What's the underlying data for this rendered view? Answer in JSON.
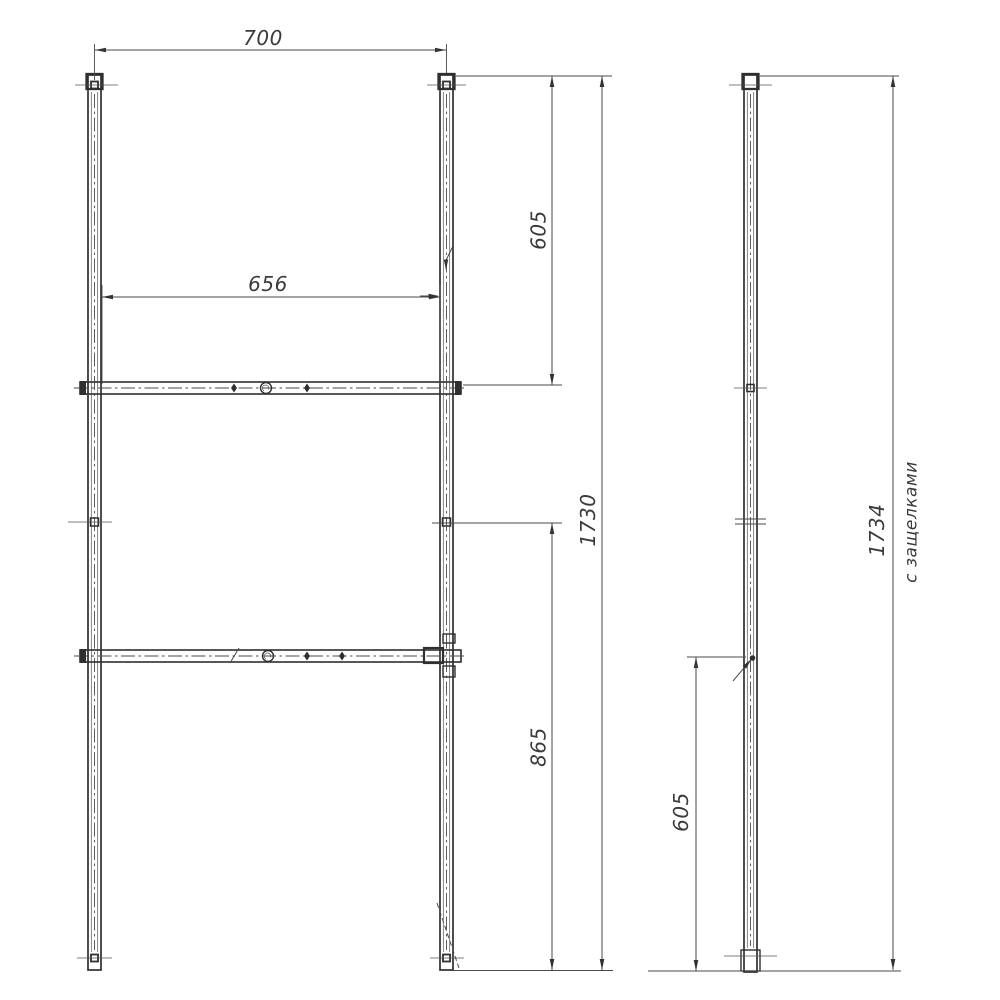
{
  "drawing": {
    "background": "#ffffff",
    "line_color": "#2f2f2f",
    "dim_color": "#4a4a4a",
    "front": {
      "width_top": "700",
      "rail_span": "656",
      "upper_height": "605",
      "total_height": "1730",
      "lower_height": "865"
    },
    "side": {
      "lower_height": "605",
      "total_height": "1734",
      "note": "с защелками"
    }
  }
}
